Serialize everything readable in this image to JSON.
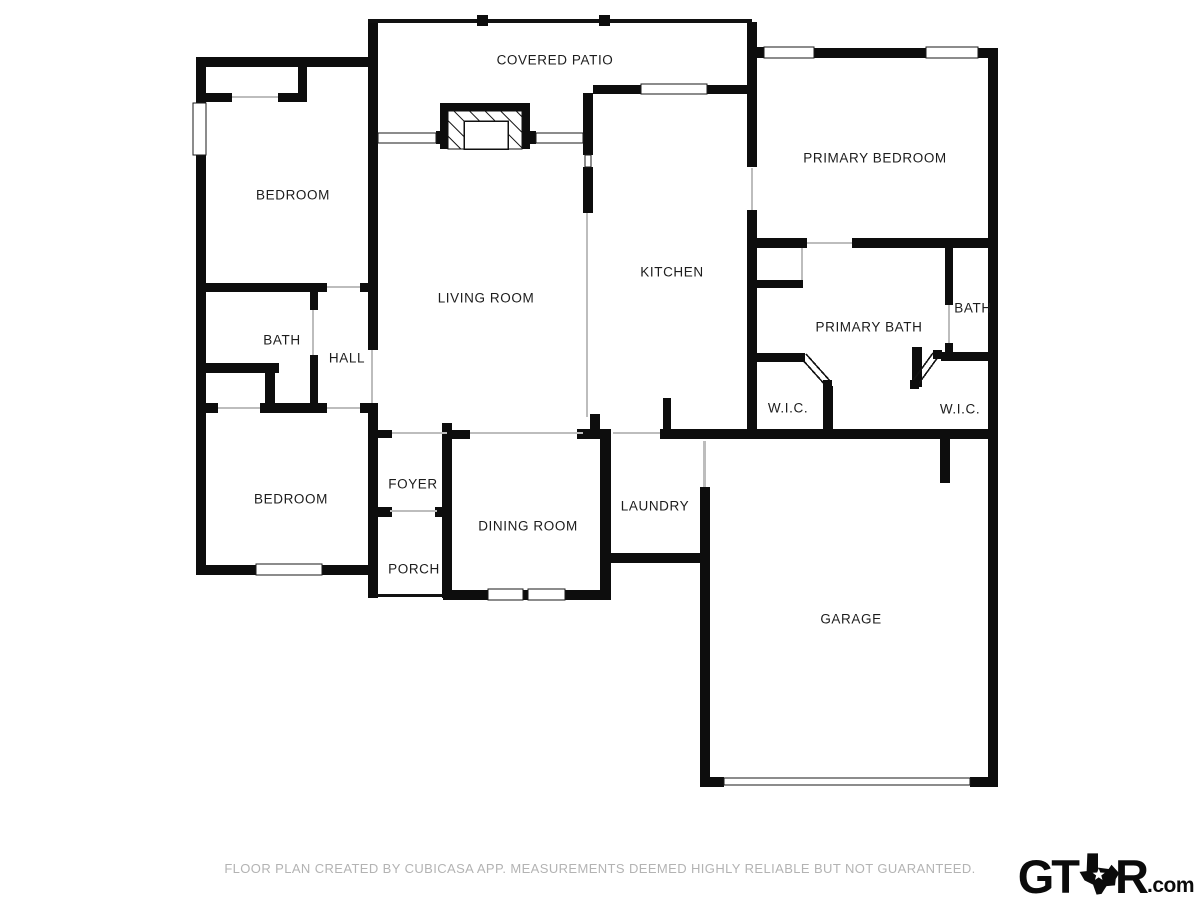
{
  "page": {
    "background": "#ffffff",
    "colors": {
      "wall": "#0d0d0d",
      "room_label_text": "#1c1c1c",
      "opening_line": "#bdbdbd",
      "disclaimer_text": "#b3b3b3",
      "logo": "#0b0b0b"
    }
  },
  "plan": {
    "rooms": {
      "covered_patio": {
        "label": "COVERED PATIO"
      },
      "bedroom_top": {
        "label": "BEDROOM"
      },
      "living_room": {
        "label": "LIVING ROOM"
      },
      "kitchen": {
        "label": "KITCHEN"
      },
      "primary_bedroom": {
        "label": "PRIMARY BEDROOM"
      },
      "primary_bath": {
        "label": "PRIMARY BATH"
      },
      "bath_right": {
        "label": "BATH"
      },
      "wic_left": {
        "label": "W.I.C."
      },
      "wic_right": {
        "label": "W.I.C."
      },
      "bath_left": {
        "label": "BATH"
      },
      "hall": {
        "label": "HALL"
      },
      "bedroom_bottom": {
        "label": "BEDROOM"
      },
      "foyer": {
        "label": "FOYER"
      },
      "porch": {
        "label": "PORCH"
      },
      "dining_room": {
        "label": "DINING ROOM"
      },
      "laundry": {
        "label": "LAUNDRY"
      },
      "garage": {
        "label": "GARAGE"
      }
    },
    "features": {
      "fireplace": "fireplace-hatched-box",
      "patio_posts": 2,
      "garage_door": "double-thin-line",
      "wic_doors": "angled-double-doors"
    }
  },
  "footer": {
    "disclaimer": "FLOOR PLAN CREATED BY CUBICASA APP. MEASUREMENTS DEEMED HIGHLY RELIABLE BUT NOT GUARANTEED."
  },
  "logo": {
    "prefix": "GT",
    "suffix": "R",
    "tld": ".com",
    "icon": "texas-star-icon"
  }
}
